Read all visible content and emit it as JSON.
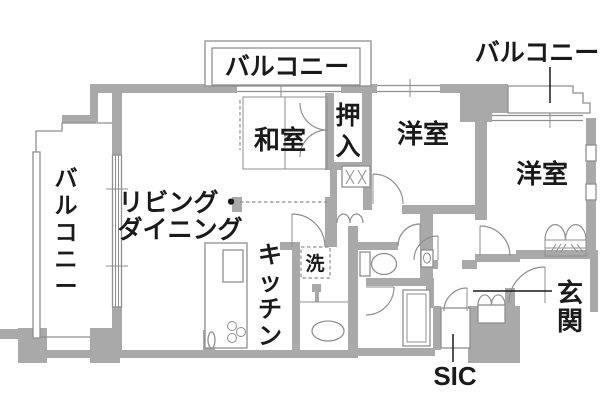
{
  "title": "apartment-floor-plan",
  "colors": {
    "background": "#ffffff",
    "wall": "#a9a9a9",
    "thin_line": "#8f8f8f",
    "text": "#1a1a1a"
  },
  "labels": {
    "balcony_left": "バルコニー",
    "balcony_top": "バルコニー",
    "balcony_right": "バルコニー",
    "japanese_room": "和室",
    "futon_closet": "押入",
    "western_room_center": "洋室",
    "western_room_right": "洋室",
    "living_dining_line1": "リビング・",
    "living_dining_line2": "ダイニング",
    "kitchen": "キッチン",
    "laundry": "洗",
    "entrance": "玄関",
    "shoe_closet": "SIC"
  }
}
